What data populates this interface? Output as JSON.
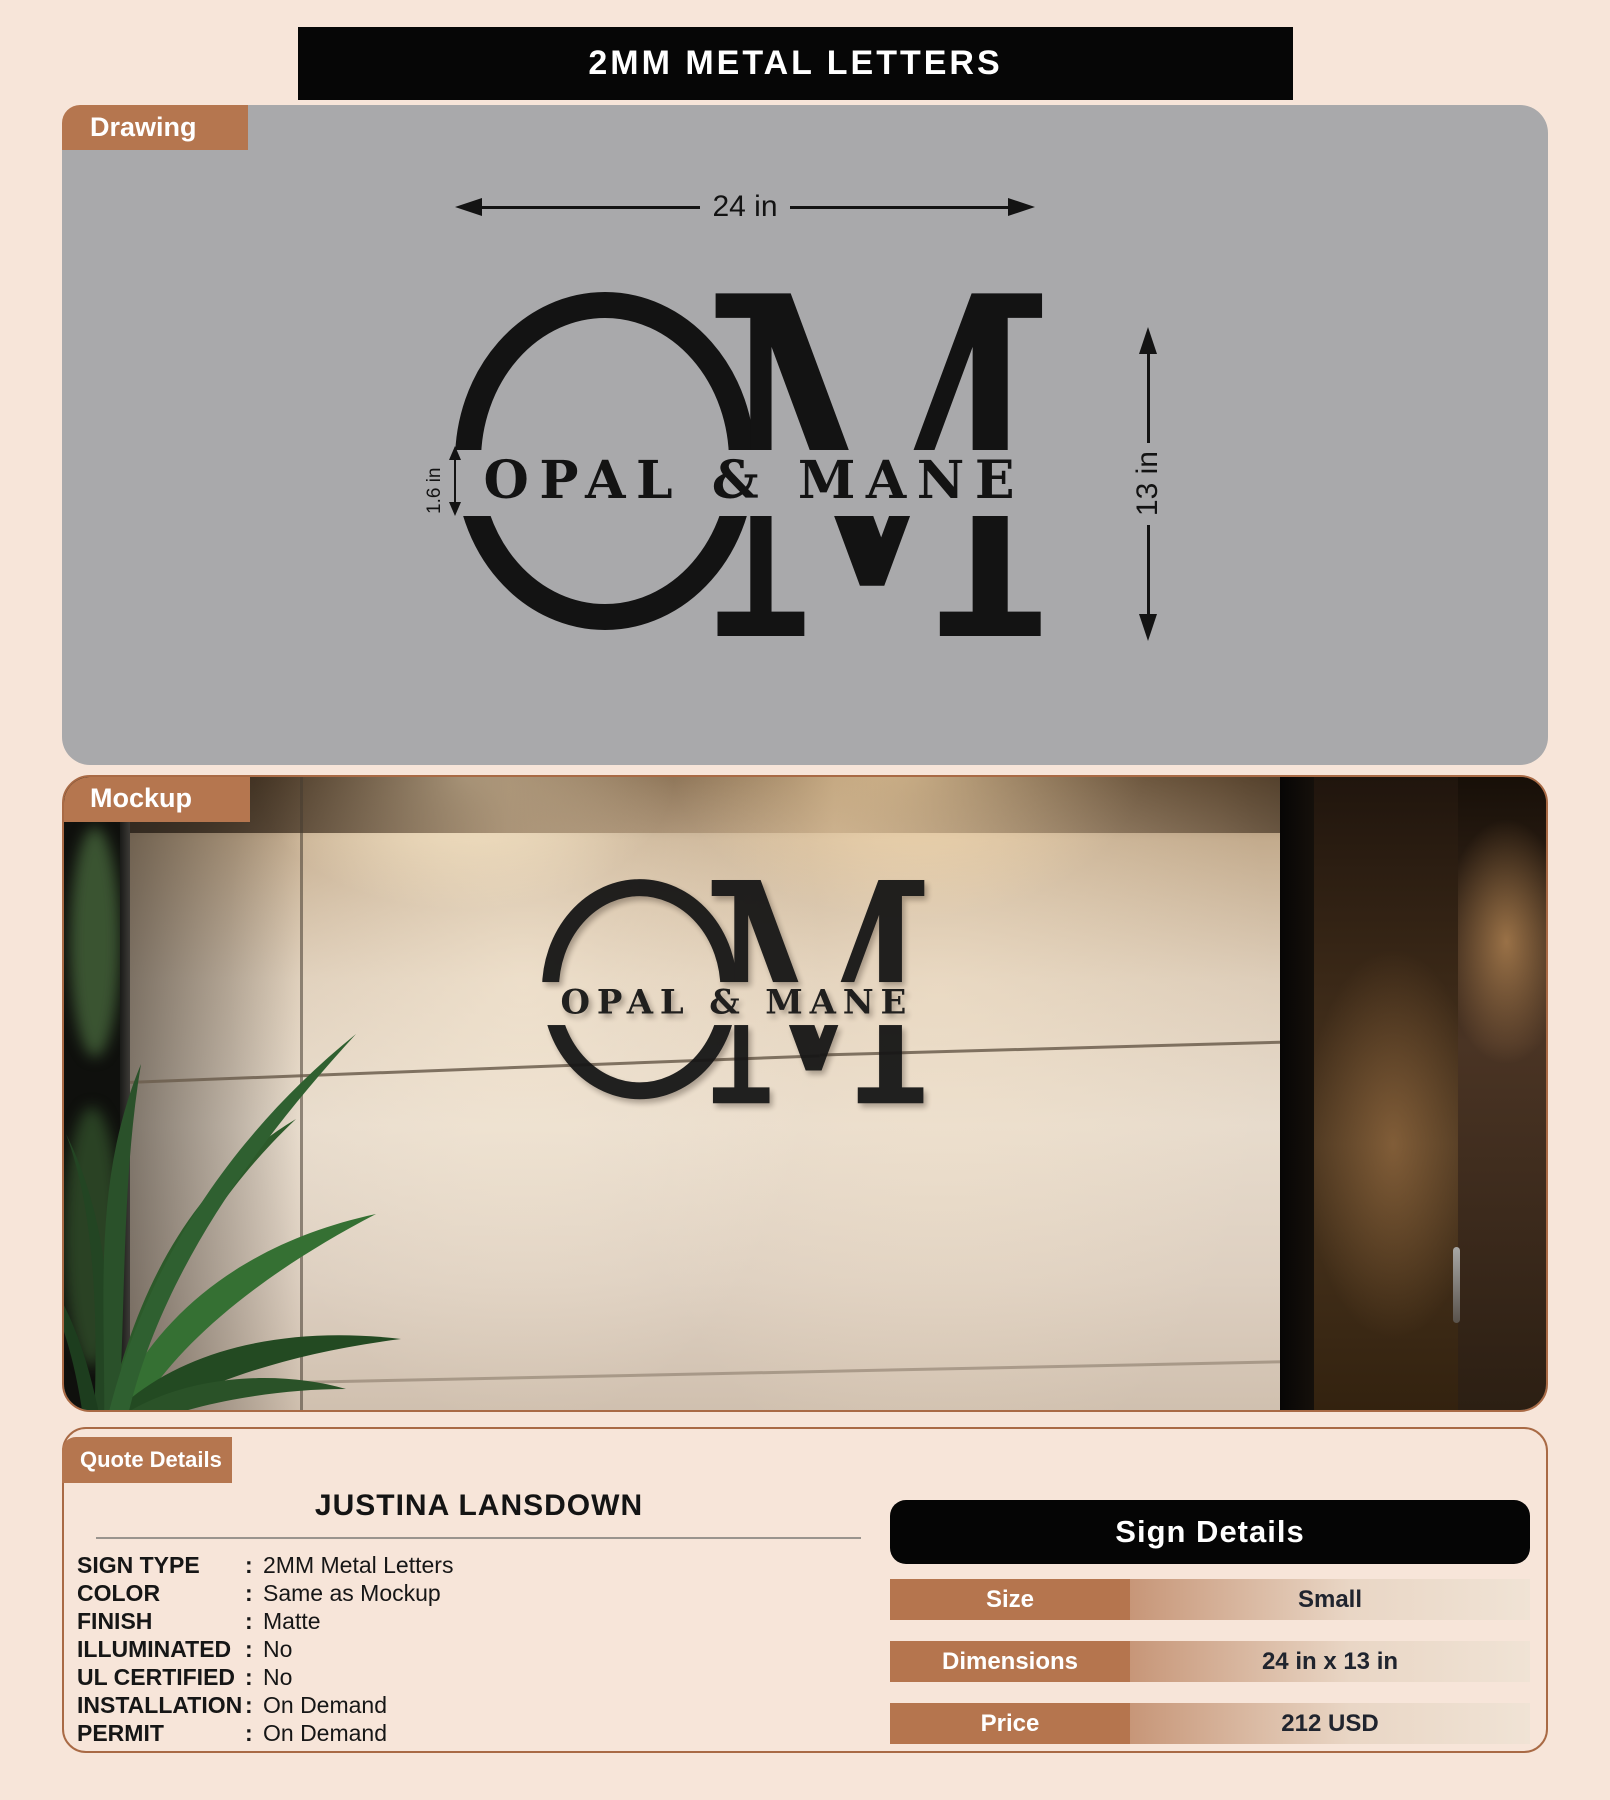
{
  "title": "2MM METAL LETTERS",
  "drawing": {
    "tab": "Drawing",
    "width_dim": "24 in",
    "height_dim": "13 in",
    "letter_dim": "1.6 in"
  },
  "mockup": {
    "tab": "Mockup"
  },
  "logo": {
    "left_letter": "O",
    "right_letter": "M",
    "wordmark": "OPAL & MANE"
  },
  "quote": {
    "tab": "Quote Details",
    "customer": "JUSTINA LANSDOWN",
    "separator": ":",
    "specs": [
      {
        "label": "SIGN TYPE",
        "value": "2MM Metal Letters"
      },
      {
        "label": "COLOR",
        "value": "Same as Mockup"
      },
      {
        "label": "FINISH",
        "value": "Matte"
      },
      {
        "label": "ILLUMINATED",
        "value": "No"
      },
      {
        "label": "UL CERTIFIED",
        "value": "No"
      },
      {
        "label": "INSTALLATION",
        "value": "On Demand"
      },
      {
        "label": "PERMIT",
        "value": "On Demand"
      }
    ]
  },
  "sign_details": {
    "title": "Sign Details",
    "rows": [
      {
        "label": "Size",
        "value": "Small"
      },
      {
        "label": "Dimensions",
        "value": "24 in x 13 in"
      },
      {
        "label": "Price",
        "value": "212 USD"
      }
    ]
  },
  "colors": {
    "accent_copper": "#b5764f",
    "page_bg": "#f7e5d9",
    "drawing_bg": "#a9a9ab",
    "bar_black": "#060606",
    "table_gradient_start": "#c79678",
    "table_gradient_end": "#f0e3d5",
    "panel_border": "#a96a45"
  }
}
